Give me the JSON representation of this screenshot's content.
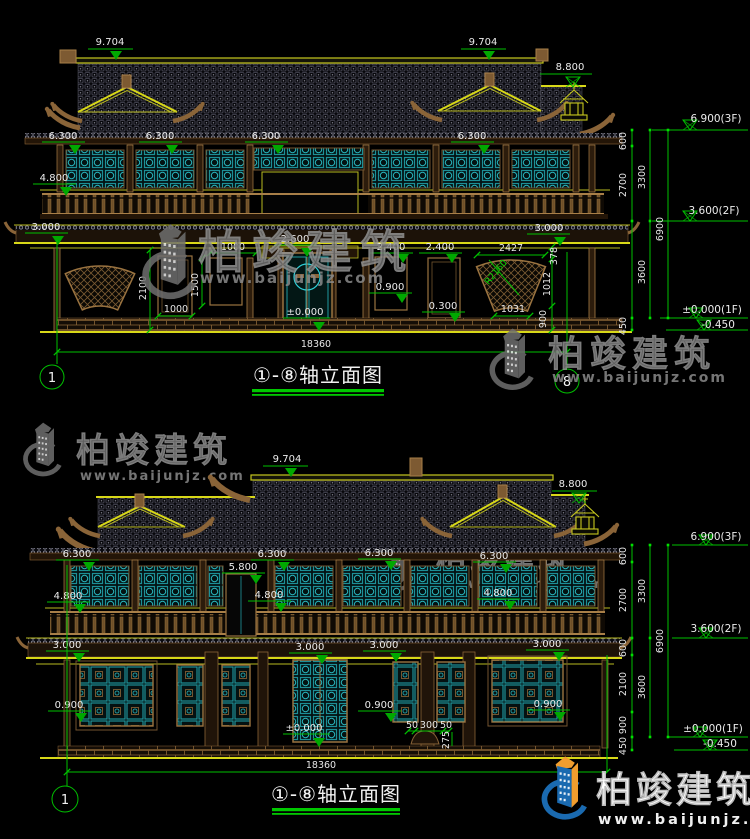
{
  "brand": {
    "name": "柏竣建筑",
    "url": "www.baijunjz.com",
    "blue": "#1a6ab0",
    "orange": "#f09d2e",
    "gray": "#6f6f6f"
  },
  "colors": {
    "background": "#000000",
    "dim_green": "#00c000",
    "cad_yellow": "#b9ba1f",
    "lattice_teal": "#1d9aa2",
    "wood_brown": "#9a7340",
    "text_white": "#e6e6e6"
  },
  "top_view": {
    "title": "①-⑧轴立面图",
    "axis_start": "1",
    "axis_end": "8",
    "overall_width": "18360",
    "levels": {
      "ridge_left": "9.704",
      "ridge_right": "9.704",
      "sub_ridge": "8.800",
      "eaves": [
        "6.300",
        "6.300",
        "6.300",
        "6.300"
      ],
      "balcony": "4.800",
      "canopy_left": "3.000",
      "canopy_right": "3.000",
      "porch": "2.600",
      "win_top_a": "2.400",
      "win_top_b": "2.400",
      "sill": "0.900",
      "low_sill": "0.300",
      "ground": "±0.000"
    },
    "dims": {
      "win_w_top": "1000",
      "win_h": "1500",
      "door_h": "2100",
      "win_w_bottom": "1000",
      "fan_w": "2427",
      "fan_gap": "378",
      "fan_radius": "R2160",
      "fan_mid": "1012",
      "fan_chord": "1031",
      "fan_base": "900"
    },
    "right_chain": {
      "seg_600": "600",
      "seg_2700": "2700",
      "seg_3300": "3300",
      "seg_3600": "3600",
      "seg_450": "450",
      "seg_6900": "6900"
    },
    "right_levels": {
      "l3f": "6.900(3F)",
      "l2f": "3.600(2F)",
      "l1f": "±0.000(1F)",
      "lbase": "-0.450"
    }
  },
  "bottom_view": {
    "title": "①-⑧轴立面图",
    "axis_start": "1",
    "overall_width": "18360",
    "levels": {
      "ridge": "9.704",
      "sub_ridge": "8.800",
      "eaves": [
        "6.300",
        "6.300",
        "6.300",
        "6.300"
      ],
      "door2f": "5.800",
      "balcony": [
        "4.800",
        "4.800",
        "4.800"
      ],
      "canopy": [
        "3.000",
        "3.000",
        "3.000",
        "3.000"
      ],
      "sill": [
        "0.900",
        "0.900",
        "0.900"
      ],
      "ground": "±0.000"
    },
    "dims": {
      "step_a": "50",
      "step_b": "300",
      "step_c": "50",
      "step_h": "275"
    },
    "right_chain": {
      "seg_600a": "600",
      "seg_2700": "2700",
      "seg_3300": "3300",
      "seg_600b": "600",
      "seg_2100": "2100",
      "seg_900": "900",
      "seg_3600": "3600",
      "seg_450": "450",
      "seg_6900": "6900"
    },
    "right_levels": {
      "l3f": "6.900(3F)",
      "l2f": "3.600(2F)",
      "l1f": "±0.000(1F)",
      "lbase": "-0.450"
    }
  }
}
